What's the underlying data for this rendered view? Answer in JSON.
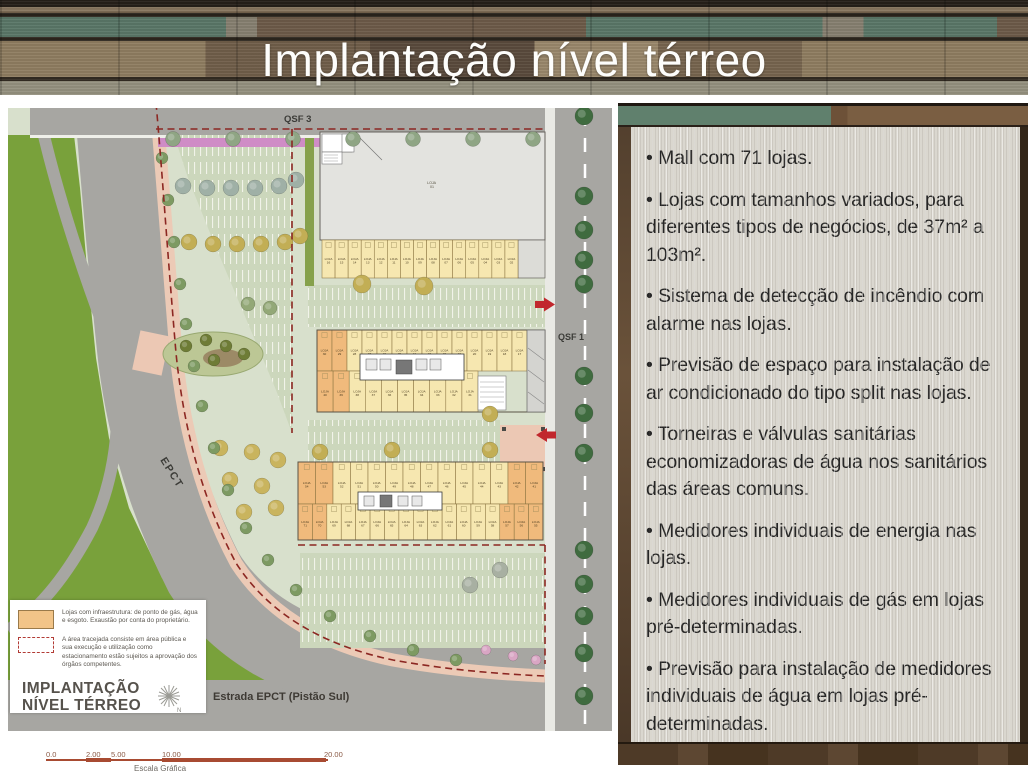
{
  "slide": {
    "title": "Implantação nível térreo"
  },
  "panel": {
    "bullets": [
      "Mall com 71 lojas.",
      "Lojas com tamanhos variados, para diferentes tipos de negócios, de 37m² a 103m².",
      "Sistema de detecção de incêndio com alarme nas lojas.",
      "Previsão de espaço para instalação de ar condicionado do tipo split nas lojas.",
      "Torneiras e válvulas sanitárias economizadoras de água nos sanitários das áreas comuns.",
      "Medidores individuais de energia nas lojas.",
      "Medidores individuais de gás em lojas pré-determinadas.",
      "Previsão para instalação de medidores individuais de água em lojas pré-determinadas."
    ]
  },
  "site_plan": {
    "street_labels": {
      "top": "QSF 3",
      "right": "QSF 1",
      "diagonal": "EPCT",
      "bottom": "Estrada EPCT (Pistão Sul)"
    },
    "anchor": {
      "line1": "LOJA",
      "line2": "01"
    },
    "unit_prefix": "LOJA",
    "unit_rows": {
      "row_a": [
        "16",
        "15",
        "14",
        "13",
        "12",
        "11",
        "10",
        "09",
        "08",
        "07",
        "06",
        "05",
        "04",
        "03",
        "02"
      ],
      "block_b_top": [
        "30",
        "29",
        "28",
        "27",
        "26",
        "25",
        "24",
        "23",
        "22",
        "21",
        "20",
        "19",
        "18",
        "17"
      ],
      "block_b_bottom": [
        "40",
        "39",
        "38",
        "37",
        "36",
        "35",
        "34",
        "33",
        "32",
        "31"
      ],
      "block_c_top": [
        "54",
        "53",
        "52",
        "51",
        "50",
        "49",
        "48",
        "47",
        "46",
        "45",
        "44",
        "43",
        "42",
        "41"
      ],
      "block_c_bottom": [
        "71",
        "70",
        "69",
        "68",
        "67",
        "66",
        "65",
        "64",
        "63",
        "62",
        "61",
        "60",
        "59",
        "58",
        "57",
        "56",
        "55"
      ]
    },
    "legend": {
      "item1": "Lojas com infraestrutura: de ponto de gás, água e esgoto. Exaustão por conta do proprietário.",
      "item2": "A área tracejada consiste em área pública e sua execução e utilização como estacionamento estão sujeitos a aprovação dos órgãos competentes.",
      "title_line1": "IMPLANTAÇÃO",
      "title_line2": "NÍVEL TÉRREO"
    },
    "scale_bar": {
      "ticks": [
        "0.0",
        "2.00",
        "5.00",
        "10.00",
        "20.00"
      ],
      "label": "Escala Gráfica"
    }
  },
  "colors": {
    "boundary_dash": "#8c2722",
    "loja_yellow": "#f6e7b0",
    "loja_orange": "#f0ba7c",
    "unit_stroke": "#8a7440",
    "grass": "#79a13b",
    "road": "#a7a6a2",
    "arrow_red": "#c1272d",
    "hedge_magenta": "#cf8cc6",
    "tree_dark": "#3f6b3f",
    "tree_olive": "#c2ae55",
    "tree_gray": "#9fb0a6",
    "tree_sage": "#7d9a62",
    "shrub_pink": "#d9a6c4"
  }
}
